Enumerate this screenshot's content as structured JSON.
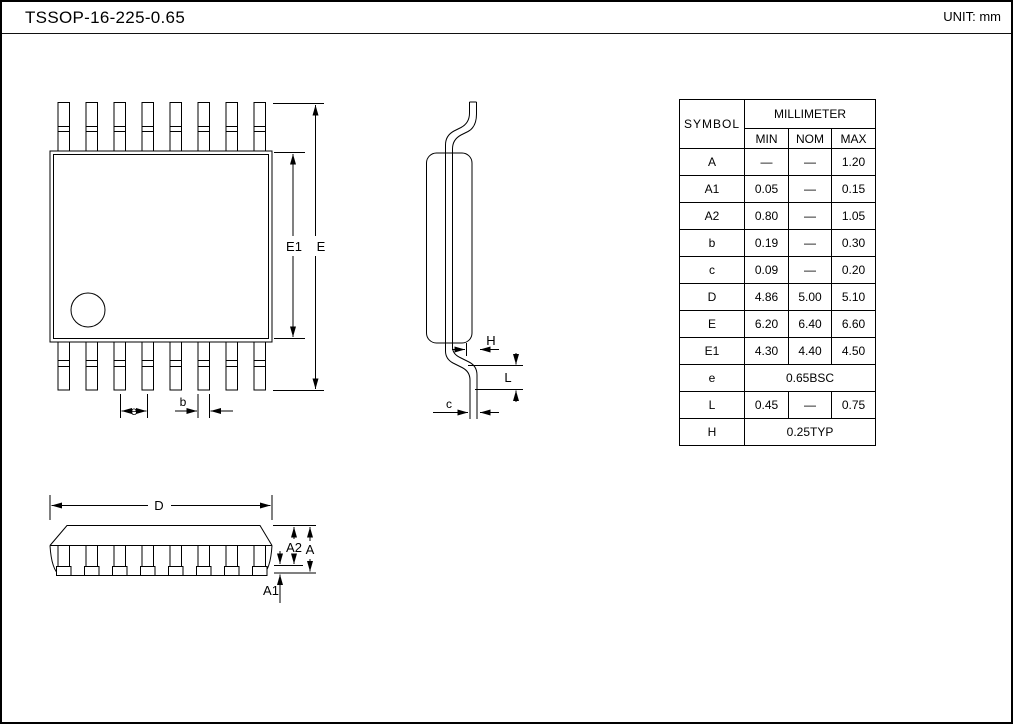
{
  "header": {
    "title": "TSSOP-16-225-0.65",
    "unit": "UNIT: mm"
  },
  "table": {
    "symbol_header": "SYMBOL",
    "group_header": "MILLIMETER",
    "columns": {
      "min": "MIN",
      "nom": "NOM",
      "max": "MAX"
    },
    "rows": [
      {
        "symbol": "A",
        "min": "—",
        "nom": "—",
        "max": "1.20"
      },
      {
        "symbol": "A1",
        "min": "0.05",
        "nom": "—",
        "max": "0.15"
      },
      {
        "symbol": "A2",
        "min": "0.80",
        "nom": "—",
        "max": "1.05"
      },
      {
        "symbol": "b",
        "min": "0.19",
        "nom": "—",
        "max": "0.30"
      },
      {
        "symbol": "c",
        "min": "0.09",
        "nom": "—",
        "max": "0.20"
      },
      {
        "symbol": "D",
        "min": "4.86",
        "nom": "5.00",
        "max": "5.10"
      },
      {
        "symbol": "E",
        "min": "6.20",
        "nom": "6.40",
        "max": "6.60"
      },
      {
        "symbol": "E1",
        "min": "4.30",
        "nom": "4.40",
        "max": "4.50"
      },
      {
        "symbol": "e",
        "value": "0.65BSC"
      },
      {
        "symbol": "L",
        "min": "0.45",
        "nom": "—",
        "max": "0.75"
      },
      {
        "symbol": "H",
        "value": "0.25TYP"
      }
    ]
  },
  "labels": {
    "E1": "E1",
    "E": "E",
    "e": "e",
    "b": "b",
    "H": "H",
    "L": "L",
    "c": "c",
    "D": "D",
    "A2": "A2",
    "A": "A",
    "A1": "A1"
  }
}
